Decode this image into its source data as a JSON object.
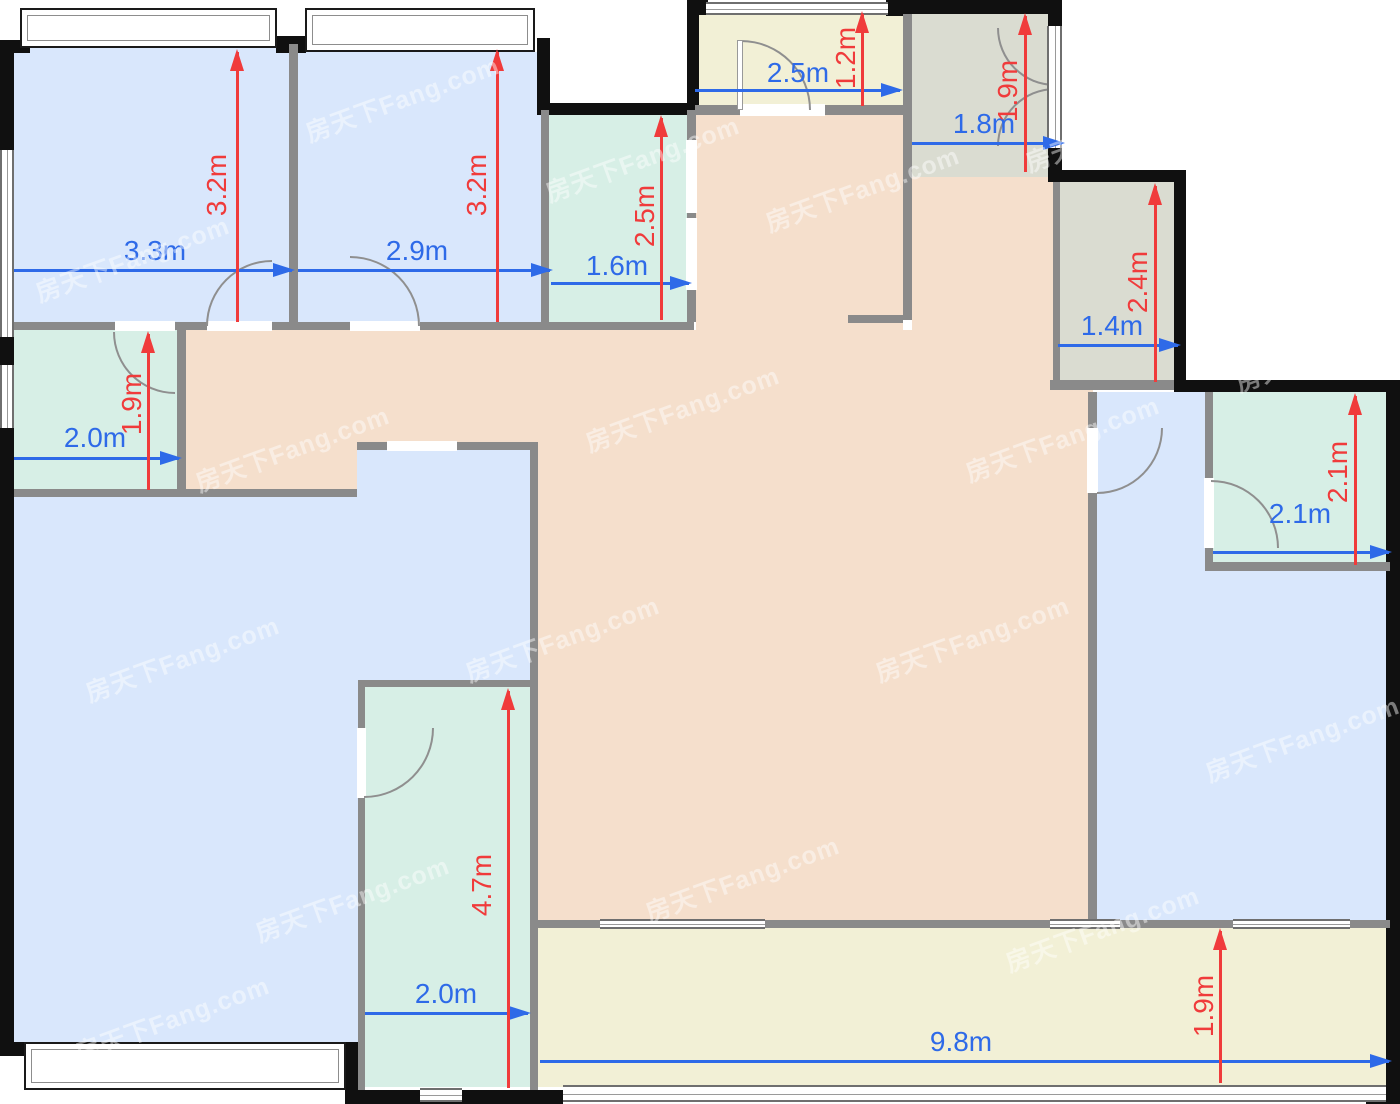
{
  "title": "apartment-floor-plan",
  "watermark": {
    "text": "房天下Fang.com"
  },
  "colors": {
    "bedroom_fill": "#d9e7fc",
    "bath_kitchen_fill": "#d7efe6",
    "living_fill": "#f5dfcc",
    "balcony_entry_fill": "#f2f0d6",
    "storage_fill": "#dadcd1",
    "wall_exterior": "#101010",
    "wall_interior": "#8a8a8a",
    "dimension_blue": "#2e6ae8",
    "dimension_red": "#f03b3b"
  },
  "dimensions": {
    "horizontal": [
      {
        "id": "bedroom1-width",
        "label": "3.3m"
      },
      {
        "id": "bedroom2-width",
        "label": "2.9m"
      },
      {
        "id": "bath-top-width",
        "label": "1.6m"
      },
      {
        "id": "entry-width",
        "label": "2.5m"
      },
      {
        "id": "storage-top-width",
        "label": "1.8m"
      },
      {
        "id": "storage-right-width",
        "label": "1.4m"
      },
      {
        "id": "bath-right-width",
        "label": "2.1m"
      },
      {
        "id": "bath-left-width",
        "label": "2.0m"
      },
      {
        "id": "kitchen-width",
        "label": "2.0m"
      },
      {
        "id": "balcony-width",
        "label": "9.8m"
      }
    ],
    "vertical": [
      {
        "id": "bedroom1-depth",
        "label": "3.2m"
      },
      {
        "id": "bedroom2-depth",
        "label": "3.2m"
      },
      {
        "id": "bath-top-depth",
        "label": "2.5m"
      },
      {
        "id": "entry-depth",
        "label": "1.2m"
      },
      {
        "id": "storage-top-depth",
        "label": "1.9m"
      },
      {
        "id": "storage-right-depth",
        "label": "2.4m"
      },
      {
        "id": "bath-right-depth",
        "label": "2.1m"
      },
      {
        "id": "bath-left-depth",
        "label": "1.9m"
      },
      {
        "id": "kitchen-depth",
        "label": "4.7m"
      },
      {
        "id": "balcony-depth",
        "label": "1.9m"
      }
    ]
  }
}
